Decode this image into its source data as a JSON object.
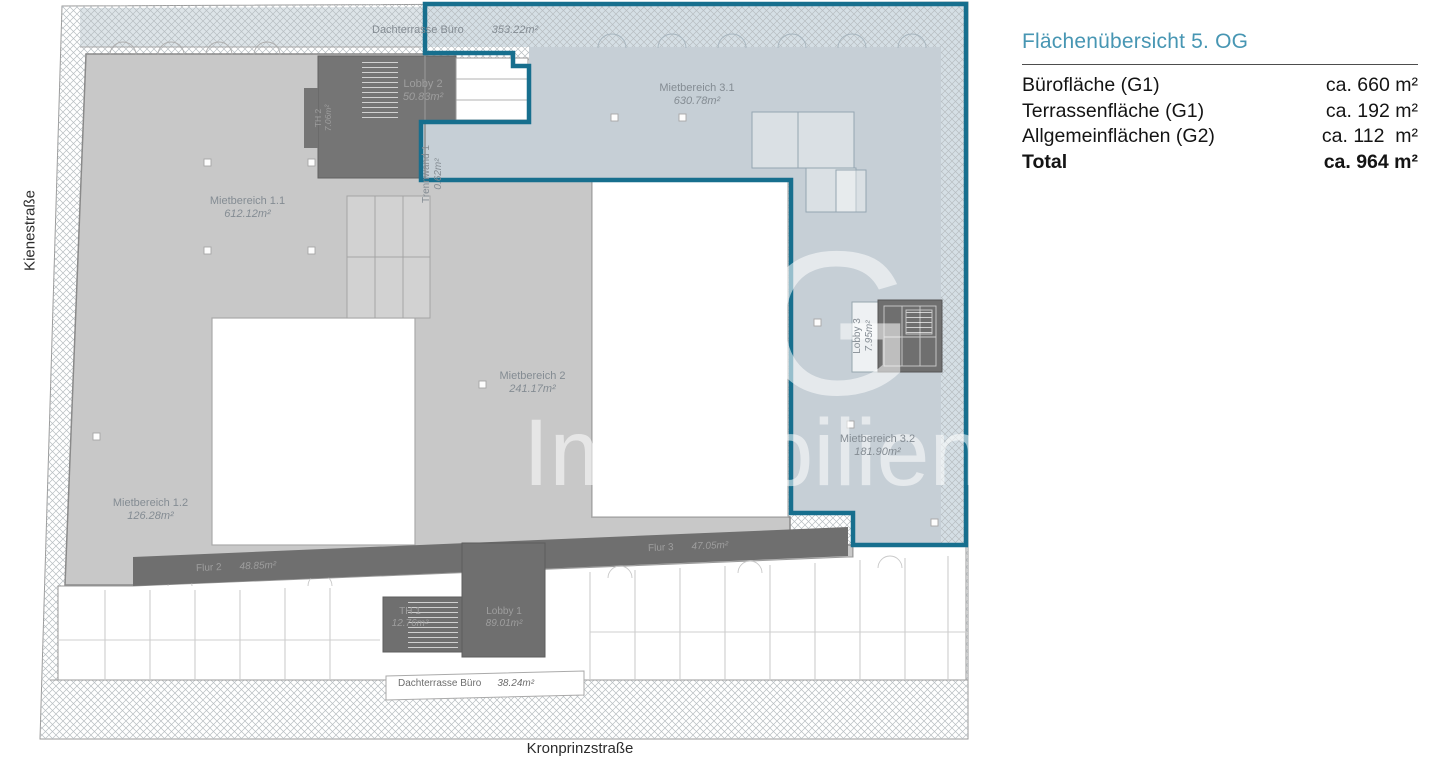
{
  "panel": {
    "title": "Flächenübersicht 5. OG",
    "rows": [
      {
        "label": "Bürofläche (G1)",
        "value": "ca. 660 m²"
      },
      {
        "label": "Terrassenfläche (G1)",
        "value": "ca. 192 m²"
      },
      {
        "label": "Allgemeinflächen (G2)",
        "value": "ca. 112  m²"
      },
      {
        "label": "Total",
        "value": "ca. 964 m²"
      }
    ]
  },
  "streets": {
    "left": "Kienestraße",
    "bottom": "Kronprinzstraße"
  },
  "plan": {
    "labels": {
      "terrace_top": {
        "name": "Dachterrasse Büro",
        "area": "353.22m²"
      },
      "mietbereich_1_1": {
        "name": "Mietbereich 1.1",
        "area": "612.12m²"
      },
      "mietbereich_1_2": {
        "name": "Mietbereich 1.2",
        "area": "126.28m²"
      },
      "mietbereich_2": {
        "name": "Mietbereich 2",
        "area": "241.17m²"
      },
      "mietbereich_3_1": {
        "name": "Mietbereich 3.1",
        "area": "630.78m²"
      },
      "mietbereich_3_2": {
        "name": "Mietbereich 3.2",
        "area": "181.90m²"
      },
      "trennwand_1": {
        "name": "Trennwand 1",
        "area": "0.62m²"
      },
      "lobby_1": {
        "name": "Lobby 1",
        "area": "89.01m²"
      },
      "lobby_2": {
        "name": "Lobby 2",
        "area": "50.83m²"
      },
      "lobby_3": {
        "name": "Lobby 3",
        "area": "7.95m²"
      },
      "th_1": {
        "name": "TH 1",
        "area": "12.76m²"
      },
      "th_2": {
        "name": "TH 2",
        "area": "7.06m²"
      },
      "flur_2": {
        "name": "Flur 2",
        "area": "48.85m²"
      },
      "flur_3": {
        "name": "Flur 3",
        "area": "47.05m²"
      },
      "terrace_bottom": {
        "name": "Dachterrasse Büro",
        "area": "38.24m²"
      }
    },
    "colors": {
      "outline_teal": "#176f8e",
      "area_blue": "#c6cfd6",
      "area_gray": "#c8c8c8",
      "area_dark": "#6f6f6f",
      "hatch_blue": "#d5dfe5"
    }
  },
  "watermark": {
    "line1": "HG",
    "line2": "Immobilien"
  }
}
